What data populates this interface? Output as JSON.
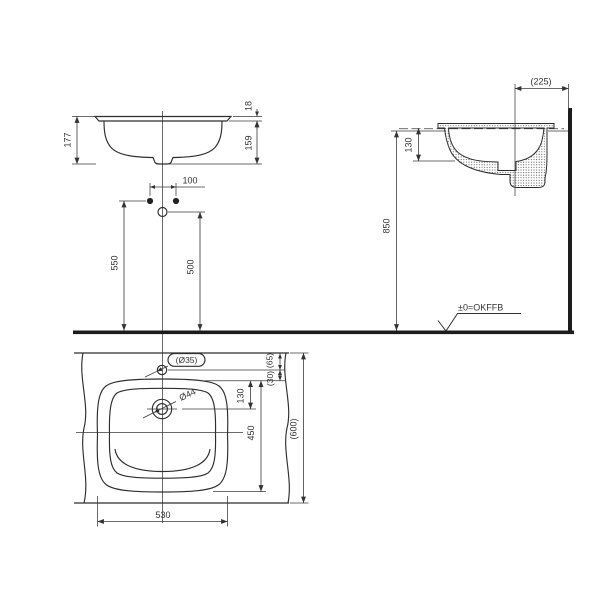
{
  "drawing": {
    "front_view": {
      "total_height": "177",
      "rim_above_counter": "18",
      "height_below_rim": "159",
      "supply_spacing": "100",
      "supply_height": "550",
      "drain_height": "500"
    },
    "side_view": {
      "drain_to_wall": "(225)",
      "bowl_depth": "130",
      "counter_height": "850",
      "floor_level_label": "±0=OKFFB"
    },
    "plan_view": {
      "faucet_hole_dia": "(Ø35)",
      "drain_hole_dia": "Ø44",
      "edge_to_faucet": "(65)",
      "faucet_to_rim": "(30)",
      "rim_to_drain": "130",
      "basin_depth": "450",
      "counter_depth": "(600)",
      "basin_width": "530"
    },
    "colors": {
      "line": "#333333",
      "background": "#ffffff"
    }
  }
}
